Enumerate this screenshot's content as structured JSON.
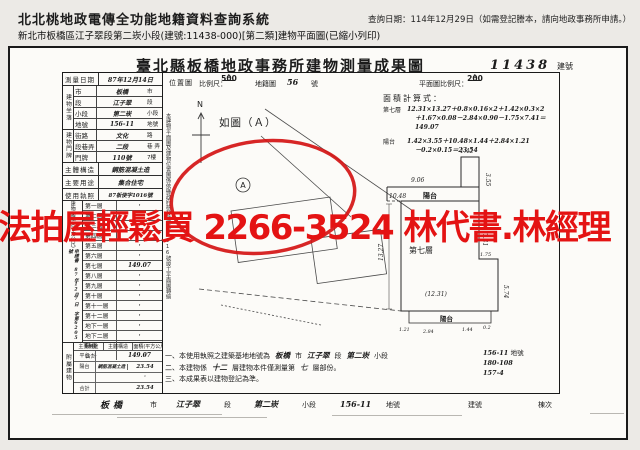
{
  "header": {
    "system_title": "北北桃地政電傳全功能地籍資料查詢系統",
    "query_date": "查詢日期：114年12月29日（如需登記謄本，請向地政事務所申請。）",
    "subtitle": "新北市板橋區江子翠段第二崁小段(建號:11438-000)[第二類]建物平面圖(已縮小列印)"
  },
  "doc": {
    "title": "臺北縣板橋地政事務所建物測量成果圖",
    "building_no": "11438",
    "building_no_label": "建號"
  },
  "watermark": {
    "text": "法拍屋輕鬆買 2266-3524 林代書.林經理",
    "color": "#e41313"
  },
  "survey": {
    "date_label": "測量日期",
    "date_value": "87年12月14日",
    "location_group_label": "建物坐落",
    "location_rows": [
      {
        "label": "市",
        "value": "板橋",
        "unit": "市"
      },
      {
        "label": "段",
        "value": "江子翠",
        "unit": "段"
      },
      {
        "label": "小段",
        "value": "第二崁",
        "unit": "小段"
      },
      {
        "label": "地號",
        "value": "156-11",
        "unit": "地號"
      }
    ],
    "address_group_label": "建物門牌",
    "address_rows": [
      {
        "label": "街路",
        "value": "文化",
        "unit": "路"
      },
      {
        "label": "段巷弄",
        "value": "二段",
        "unit": "巷 弄"
      },
      {
        "label": "門牌",
        "value": "110號",
        "unit": "7樓"
      }
    ],
    "structure_label": "主體構造",
    "structure_value": "鋼筋混凝土造",
    "usage_label": "主要用途",
    "usage_value": "集合住宅",
    "license_label": "使用執照",
    "license_value": "87板使字1016號",
    "area_group_label": "建物面積（平方公尺）",
    "application_note": "申請書 87年12月7日 字第6205號",
    "floors": [
      {
        "label": "第一層",
        "value": "·"
      },
      {
        "label": "第二層",
        "value": "·"
      },
      {
        "label": "第三層",
        "value": "·"
      },
      {
        "label": "第四層",
        "value": "·"
      },
      {
        "label": "第五層",
        "value": "·"
      },
      {
        "label": "第六層",
        "value": "·"
      },
      {
        "label": "第七層",
        "value": "149.07"
      },
      {
        "label": "第八層",
        "value": "·"
      },
      {
        "label": "第九層",
        "value": "·"
      },
      {
        "label": "第十層",
        "value": "·"
      },
      {
        "label": "第十一層",
        "value": "·"
      },
      {
        "label": "第十二層",
        "value": "·"
      },
      {
        "label": "地下一層",
        "value": "·"
      },
      {
        "label": "地下二層",
        "value": "·"
      },
      {
        "label": "騎樓",
        "value": "·"
      },
      {
        "label": "合計",
        "value": "149.07"
      }
    ],
    "attached_group_label": "附屬建物",
    "attached_header": {
      "usage": "主要用途",
      "structure": "主體構造",
      "area": "面積(平方公尺)"
    },
    "attached_rows": [
      {
        "usage": "平台",
        "structure": "",
        "area": "·"
      },
      {
        "usage": "陽台",
        "structure": "鋼筋混凝土造",
        "area": "23.54"
      },
      {
        "usage": "",
        "structure": "",
        "area": "·"
      },
      {
        "usage": "合計",
        "structure": "",
        "area": "23.54"
      }
    ]
  },
  "map": {
    "location_label": "位置圖",
    "scale_label": "比例尺：",
    "scale_num": "1",
    "scale_den": "500",
    "cadastre_label": "地籍圖",
    "cadastre_no": "56",
    "cadastre_unit": "號",
    "plan_scale_label": "平面圖比例尺：",
    "plan_scale_num": "1",
    "plan_scale_den": "200",
    "north_label": "N",
    "figure_ref": "如圖（Ａ）",
    "point_label": "A",
    "vertical_note": "本建物平面圖及建物位置圖係依縣政府核發使字第1016號竣工平面圖轉繪"
  },
  "calc": {
    "title": "面積計算式：",
    "line1_label": "第七層",
    "line1a": "12.31×13.27＋0.8×0.16×2＋1.42×0.3×2",
    "line1b": "＋1.67×0.08－2.84×0.90－1.75×7.41＝149.07",
    "line2_label": "陽台",
    "line2a": "1.42×3.55＋10.48×1.44＋2.84×1.21",
    "line2b": "－0.2×0.15＝23.54"
  },
  "plan": {
    "floor_label": "第七層",
    "balcony_label": "陽台",
    "balcony_bottom_label": "陽台",
    "dims": {
      "notch_w": "1.42",
      "notch_h": "3.55",
      "top_left": "9.06",
      "balcony_w": "10.48",
      "right_h": "7.41",
      "step_w": "1.75",
      "right_lower_h": "5.74",
      "left_h": "13.27",
      "body_w": "(12.31)",
      "b1": "1.21",
      "b2": "2.84",
      "b3": "1.44",
      "b4": "0.2"
    }
  },
  "notes": {
    "n1_prefix": "一、本使用執照之建築基地地號為",
    "n1_city": "板橋",
    "n1_city_unit": "市",
    "n1_sec": "江子翠",
    "n1_sec_unit": "段",
    "n1_subsec": "第二崁",
    "n1_subsec_unit": "小段",
    "n1_lot1": "156-11",
    "n1_lot1_unit": "地號",
    "n1_lot2": "180-108",
    "n1_lot3": "157-4",
    "n2_prefix": "二、本建物係",
    "n2_floors": "十二",
    "n2_mid": "層建物本件僅測量第",
    "n2_floor": "七",
    "n2_suffix": "層部份。",
    "n3": "三、本成果表以建物登記為準。"
  },
  "footer": {
    "city": "板橋",
    "city_unit": "市",
    "sec": "江子翠",
    "sec_unit": "段",
    "subsec": "第二崁",
    "subsec_unit": "小段",
    "lot": "156-11",
    "lot_unit": "地號",
    "bno_label": "建號",
    "building_unit_label": "棟次"
  }
}
